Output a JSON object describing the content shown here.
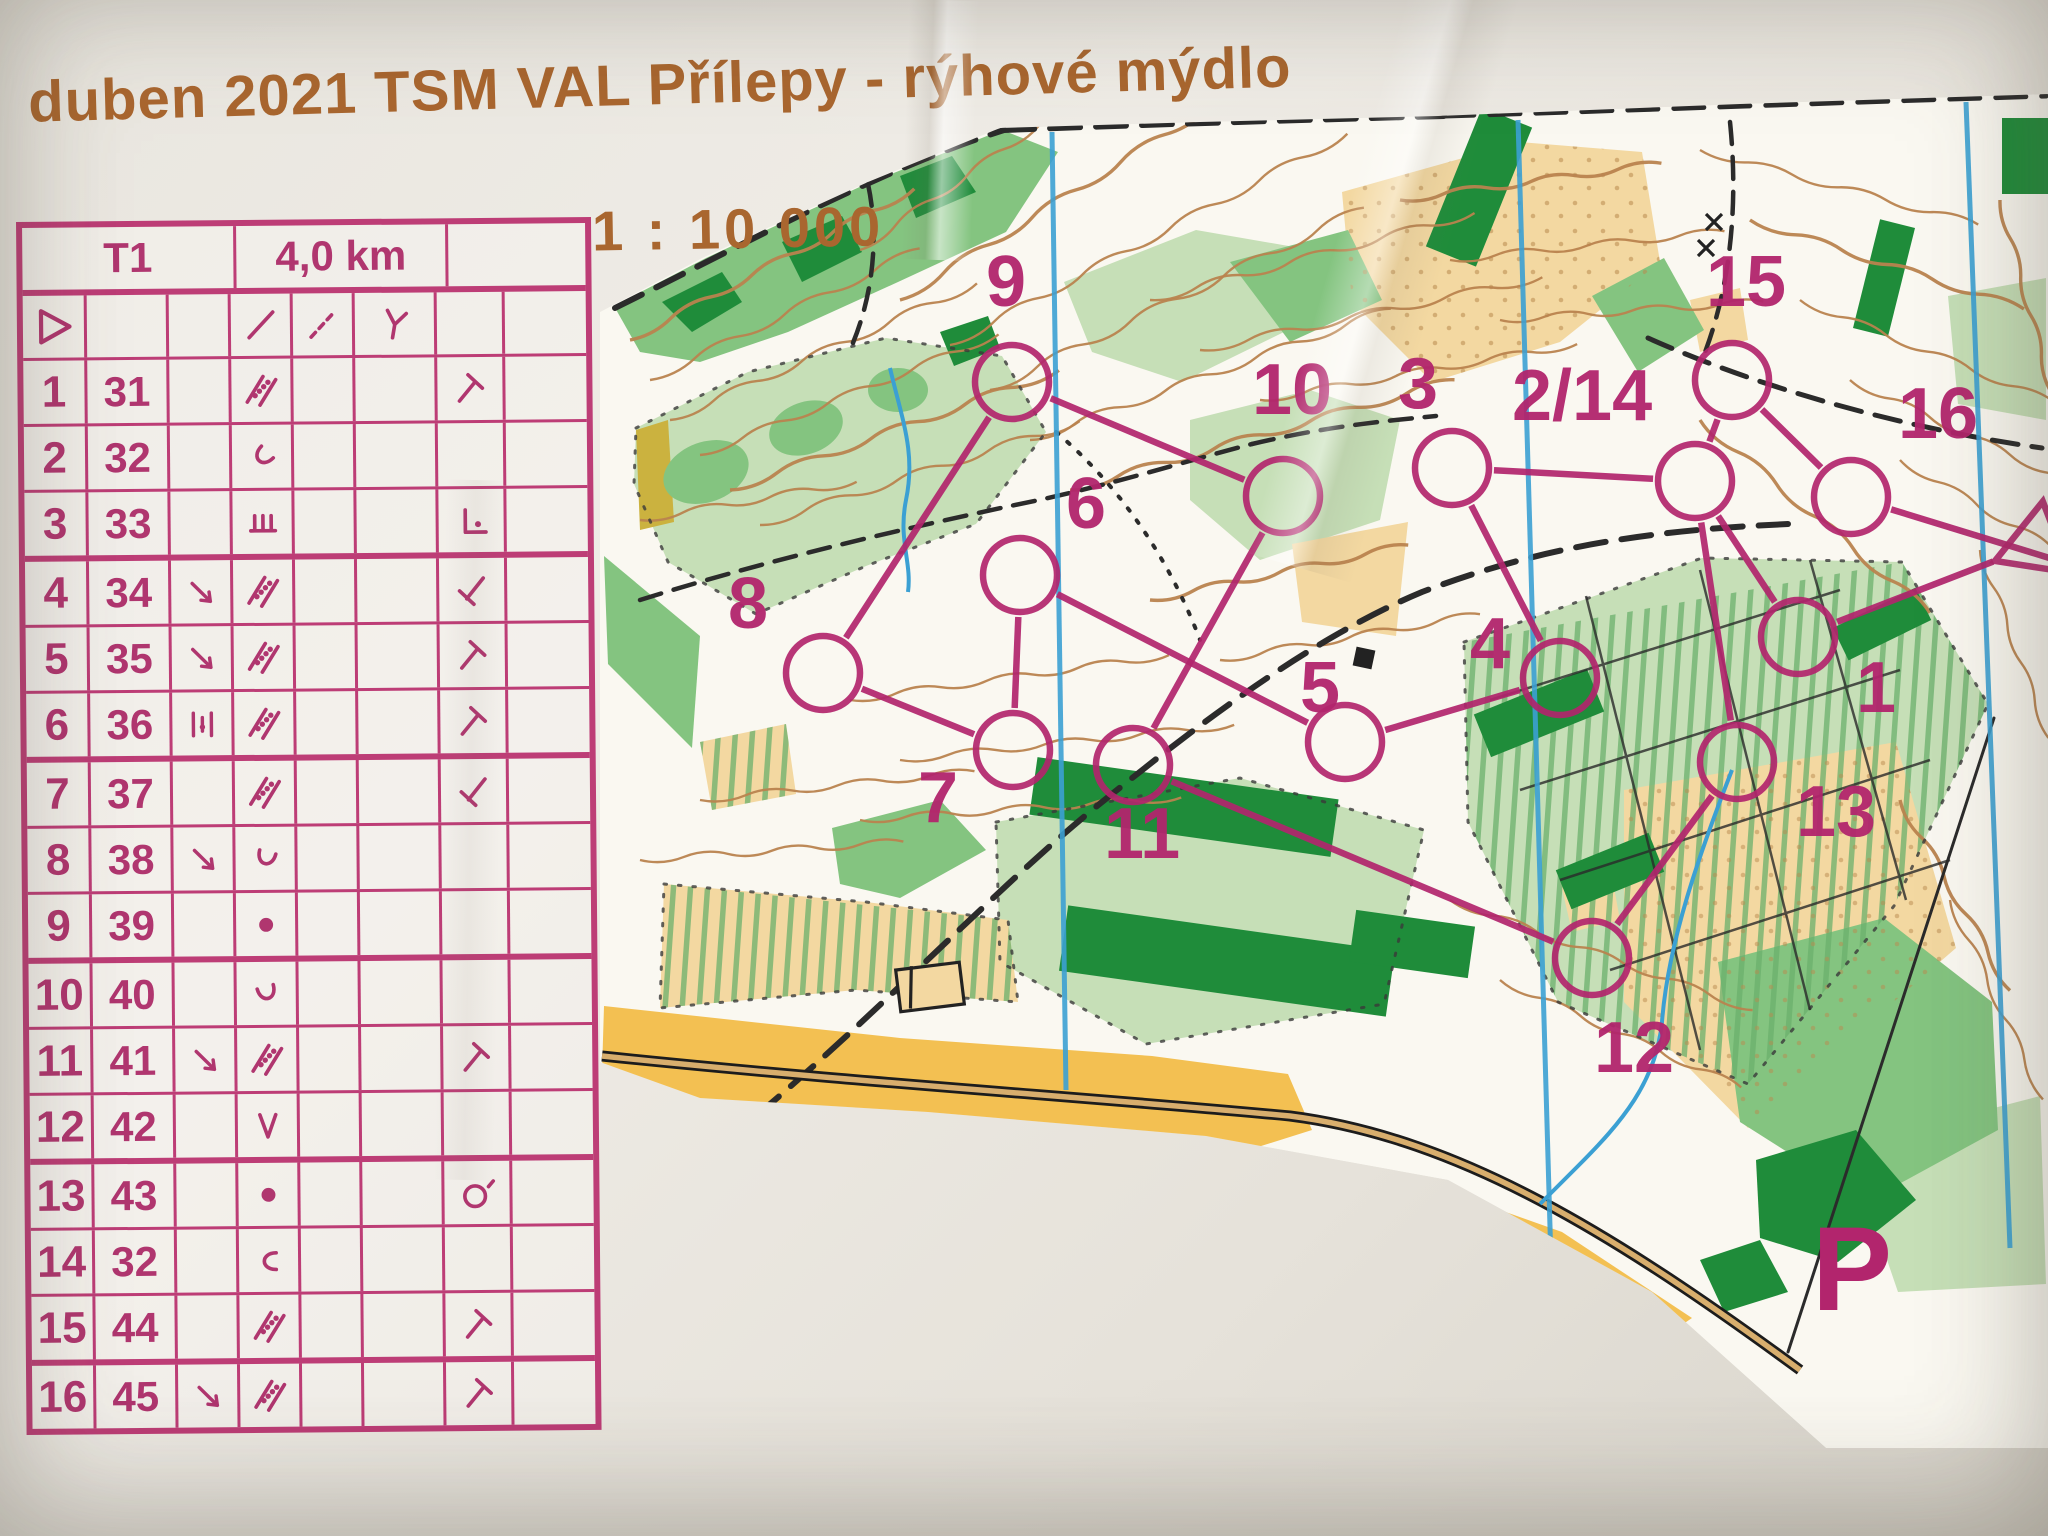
{
  "title": "duben 2021 TSM VAL Přílepy - rýhové mýdlo",
  "scale_label": "1 : 10 000",
  "colors": {
    "title_brown": "#a9662f",
    "table_pink": "#bd3d76",
    "course_purple": "#b2256d",
    "map_yellow": "#f3c052",
    "map_tan": "#f3d8a1",
    "map_light_green": "#c6dfb7",
    "map_green": "#84c480",
    "map_dark_green": "#1f8c3a",
    "contour_brown": "#b9834e",
    "water_blue": "#3ba0d3"
  },
  "control_card": {
    "course_name": "T1",
    "course_length": "4,0 km",
    "climb": "",
    "start_row": {
      "a_symbol": "start-triangle",
      "d_symbol": "slash",
      "e_symbol": "dashed-slash",
      "f_symbol": "y-junction"
    },
    "rows": [
      {
        "no": "1",
        "code": "31",
        "c": "",
        "d": "clearing",
        "d_rot": 0,
        "g": "t-ne"
      },
      {
        "no": "2",
        "code": "32",
        "c": "",
        "d": "gully-u",
        "d_rot": 45,
        "g": ""
      },
      {
        "no": "3",
        "code": "33",
        "c": "",
        "d": "comb",
        "d_rot": 0,
        "g": "corner-dot"
      },
      {
        "no": "4",
        "code": "34",
        "c": "arrow-se",
        "d": "clearing",
        "d_rot": 0,
        "g": "t-sw"
      },
      {
        "no": "5",
        "code": "35",
        "c": "arrow-se",
        "d": "clearing",
        "d_rot": 0,
        "g": "t-ne"
      },
      {
        "no": "6",
        "code": "36",
        "c": "between",
        "d": "clearing",
        "d_rot": 0,
        "g": "t-ne"
      },
      {
        "no": "7",
        "code": "37",
        "c": "",
        "d": "clearing",
        "d_rot": 0,
        "g": "t-sw"
      },
      {
        "no": "8",
        "code": "38",
        "c": "arrow-se",
        "d": "gully-u",
        "d_rot": 15,
        "g": ""
      },
      {
        "no": "9",
        "code": "39",
        "c": "",
        "d": "dot",
        "d_rot": 0,
        "g": ""
      },
      {
        "no": "10",
        "code": "40",
        "c": "",
        "d": "gully-u",
        "d_rot": -15,
        "g": ""
      },
      {
        "no": "11",
        "code": "41",
        "c": "arrow-se",
        "d": "clearing",
        "d_rot": 0,
        "g": "t-ne"
      },
      {
        "no": "12",
        "code": "42",
        "c": "",
        "d": "v-shape",
        "d_rot": 0,
        "g": ""
      },
      {
        "no": "13",
        "code": "43",
        "c": "",
        "d": "dot",
        "d_rot": 0,
        "g": "circle-tick"
      },
      {
        "no": "14",
        "code": "32",
        "c": "",
        "d": "gully-u",
        "d_rot": 90,
        "g": ""
      },
      {
        "no": "15",
        "code": "44",
        "c": "",
        "d": "clearing",
        "d_rot": 0,
        "g": "t-ne"
      },
      {
        "no": "16",
        "code": "45",
        "c": "arrow-se",
        "d": "clearing",
        "d_rot": 0,
        "g": "t-ne"
      }
    ]
  },
  "map": {
    "parking_label": "P",
    "controls": [
      {
        "label": "1",
        "x": 1798,
        "y": 637,
        "lx": 1856,
        "ly": 712
      },
      {
        "label": "2/14",
        "x": 1695,
        "y": 481,
        "lx": 1512,
        "ly": 420
      },
      {
        "label": "3",
        "x": 1452,
        "y": 468,
        "lx": 1398,
        "ly": 408
      },
      {
        "label": "4",
        "x": 1560,
        "y": 678,
        "lx": 1470,
        "ly": 668
      },
      {
        "label": "5",
        "x": 1345,
        "y": 742,
        "lx": 1300,
        "ly": 712
      },
      {
        "label": "6",
        "x": 1020,
        "y": 575,
        "lx": 1066,
        "ly": 528
      },
      {
        "label": "7",
        "x": 1013,
        "y": 750,
        "lx": 918,
        "ly": 822
      },
      {
        "label": "8",
        "x": 823,
        "y": 673,
        "lx": 728,
        "ly": 628
      },
      {
        "label": "9",
        "x": 1012,
        "y": 382,
        "lx": 986,
        "ly": 306
      },
      {
        "label": "10",
        "x": 1283,
        "y": 496,
        "lx": 1252,
        "ly": 414
      },
      {
        "label": "11",
        "x": 1133,
        "y": 765,
        "lx": 1104,
        "ly": 858
      },
      {
        "label": "12",
        "x": 1592,
        "y": 958,
        "lx": 1594,
        "ly": 1072
      },
      {
        "label": "13",
        "x": 1737,
        "y": 762,
        "lx": 1796,
        "ly": 836
      },
      {
        "label": "15",
        "x": 1732,
        "y": 380,
        "lx": 1706,
        "ly": 306
      },
      {
        "label": "16",
        "x": 1851,
        "y": 497,
        "lx": 1898,
        "ly": 438
      }
    ],
    "start": {
      "x": 2036,
      "y": 545
    },
    "finish_exit": {
      "x": 2056,
      "y": 560
    },
    "leg_sequence": [
      "S",
      "1",
      "2/14",
      "3",
      "4",
      "5",
      "6",
      "7",
      "8",
      "9",
      "10",
      "11",
      "12",
      "13",
      "2/14",
      "15",
      "16",
      "F"
    ]
  }
}
